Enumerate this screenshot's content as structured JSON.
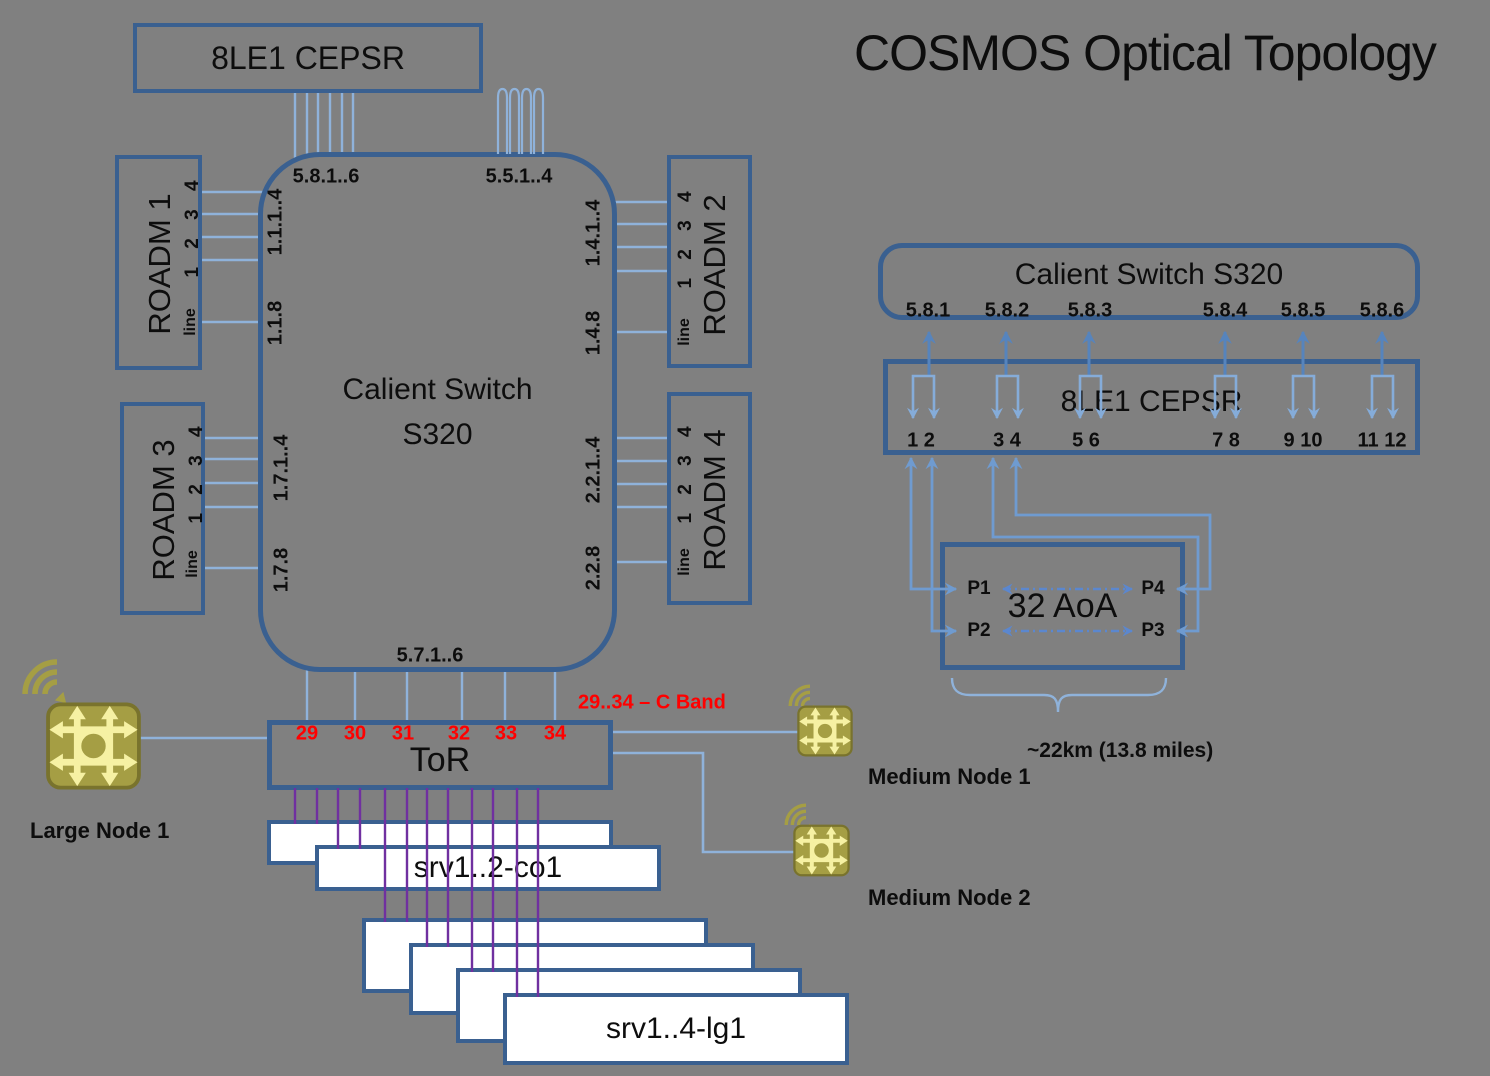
{
  "title": "COSMOS Optical Topology",
  "colors": {
    "background": "#808080",
    "box_border": "#3a6090",
    "light_line": "#8fb2da",
    "medium_line": "#5684bd",
    "purple_line": "#7030a0",
    "red_label": "#ff0000",
    "icon_body": "#a59e44",
    "icon_arrows": "#f6f1a3"
  },
  "left_diagram": {
    "cepsr_box": "8LE1 CEPSR",
    "switch_box": {
      "line1": "Calient Switch",
      "line2": "S320"
    },
    "switch_ports": {
      "top_left": "5.8.1..6",
      "top_loop": "5.5.1..4",
      "bottom": "5.7.1..6",
      "roadm1_data": "1.1.1..4",
      "roadm1_line": "1.1.8",
      "roadm2_data": "1.4.1..4",
      "roadm2_line": "1.4.8",
      "roadm3_data": "1.7.1..4",
      "roadm3_line": "1.7.8",
      "roadm4_data": "2.2.1..4",
      "roadm4_line": "2.2.8"
    },
    "roadm_boxes": {
      "names": [
        "ROADM 1",
        "ROADM 2",
        "ROADM 3",
        "ROADM 4"
      ],
      "ports": "1 2 3 4",
      "line_port": "line"
    },
    "tor_box": {
      "label": "ToR",
      "ports": [
        "29",
        "30",
        "31",
        "32",
        "33",
        "34"
      ],
      "note": "29..34 – C Band"
    },
    "server_boxes": {
      "co": "srv1..2-co1",
      "lg": "srv1..4-lg1"
    },
    "nodes": {
      "large": "Large Node 1",
      "medium1": "Medium Node 1",
      "medium2": "Medium Node 2"
    }
  },
  "right_diagram": {
    "calient_box": "Calient Switch S320",
    "calient_ports": [
      "5.8.1",
      "5.8.2",
      "5.8.3",
      "5.8.4",
      "5.8.5",
      "5.8.6"
    ],
    "cepsr_box": "8LE1 CEPSR",
    "cepsr_port_pairs": [
      "1 2",
      "3 4",
      "5 6",
      "7 8",
      "9 10",
      "11 12"
    ],
    "aoa_box": {
      "label": "32 AoA",
      "p1": "P1",
      "p2": "P2",
      "p3": "P3",
      "p4": "P4"
    },
    "distance_note": "~22km (13.8 miles)"
  }
}
